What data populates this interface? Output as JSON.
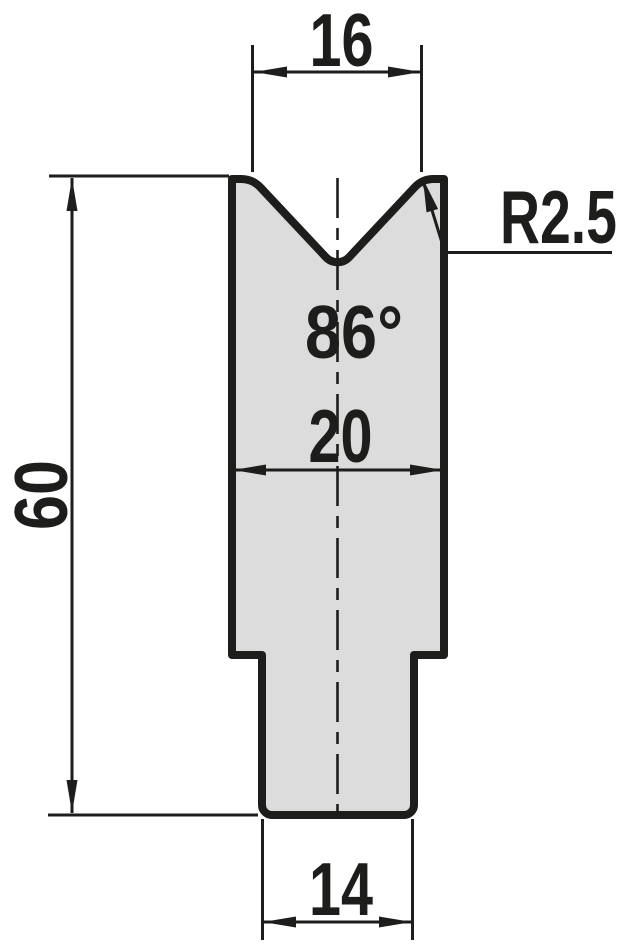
{
  "drawing": {
    "kind": "v-die-cross-section"
  },
  "dims": {
    "groove_opening_width": "16",
    "shoulder_radius": "R2.5",
    "groove_angle": "86°",
    "body_width": "20",
    "total_height": "60",
    "tang_width": "14"
  },
  "colors": {
    "outline": "#1d1d1b",
    "part_fill": "#dcdcdc",
    "background": "#ffffff"
  }
}
